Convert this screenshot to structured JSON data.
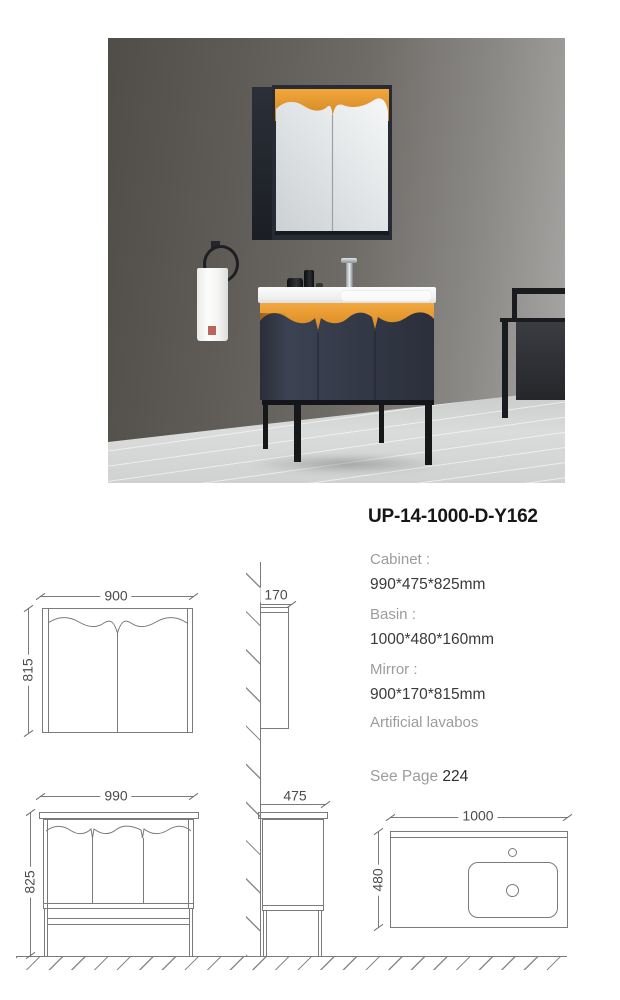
{
  "product": {
    "code": "UP-14-1000-D-Y162",
    "cabinet_label": "Cabinet :",
    "cabinet_value": "990*475*825mm",
    "basin_label": "Basin :",
    "basin_value": "1000*480*160mm",
    "mirror_label": "Mirror :",
    "mirror_value": "900*170*815mm",
    "material": "Artificial lavabos",
    "see_page_label": "See Page",
    "see_page_number": "224"
  },
  "drawings": {
    "mirror_front": {
      "width": "900",
      "height": "815"
    },
    "mirror_side": {
      "depth": "170"
    },
    "cabinet_side": {
      "depth": "475"
    },
    "cabinet_front": {
      "width": "990",
      "height": "825"
    },
    "basin_top": {
      "width": "1000",
      "depth": "480"
    }
  },
  "photo": {
    "subject": "bathroom vanity with mirror cabinet, towel ring and chair",
    "colors": {
      "cabinet_navy": "#333a49",
      "accent_orange": "#e8962e",
      "counter_white": "#f4f6f5",
      "wall_gray": "#6b6864",
      "floor_gray": "#d6d8d7",
      "drawing_line": "#7a7a7a"
    }
  }
}
